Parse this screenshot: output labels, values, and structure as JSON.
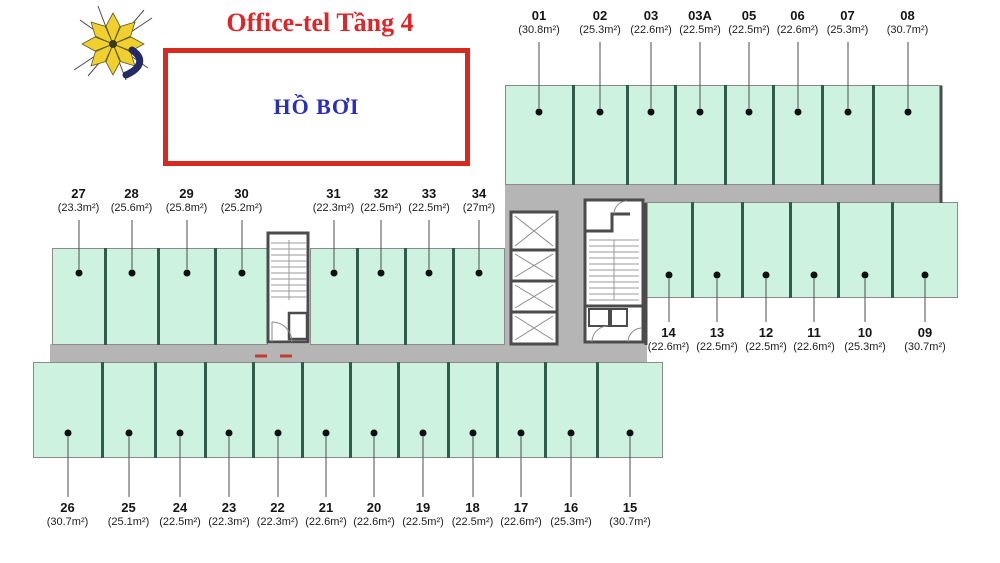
{
  "header": {
    "title": "Office-tel Tầng 4",
    "pool_label": "HỒ BƠI",
    "logo_icon": "pinwheel-flower-logo"
  },
  "colors": {
    "title_red": "#e02528",
    "box_border_red": "#d7291e",
    "pool_blue": "#2a2ebd",
    "unit_fill": "#cdf2e0",
    "unit_divider": "#2e5d4c",
    "corridor_gray": "#b5b5b5",
    "wall_dark": "#4b4b4b",
    "marker_black": "#101010",
    "door_mark_red": "#c23b2e"
  },
  "plan": {
    "rows": {
      "top": {
        "units": [
          {
            "no": "01",
            "area": "(30.8m²)"
          },
          {
            "no": "02",
            "area": "(25.3m²)"
          },
          {
            "no": "03",
            "area": "(22.6m²)"
          },
          {
            "no": "03A",
            "area": "(22.5m²)"
          },
          {
            "no": "05",
            "area": "(22.5m²)"
          },
          {
            "no": "06",
            "area": "(22.6m²)"
          },
          {
            "no": "07",
            "area": "(25.3m²)"
          },
          {
            "no": "08",
            "area": "(30.7m²)"
          }
        ]
      },
      "mid_left": {
        "units": [
          {
            "no": "27",
            "area": "(23.3m²)"
          },
          {
            "no": "28",
            "area": "(25.6m²)"
          },
          {
            "no": "29",
            "area": "(25.8m²)"
          },
          {
            "no": "30",
            "area": "(25.2m²)"
          },
          {
            "no": "31",
            "area": "(22.3m²)"
          },
          {
            "no": "32",
            "area": "(22.5m²)"
          },
          {
            "no": "33",
            "area": "(22.5m²)"
          },
          {
            "no": "34",
            "area": "(27m²)"
          }
        ]
      },
      "mid_right": {
        "units": [
          {
            "no": "14",
            "area": "(22.6m²)"
          },
          {
            "no": "13",
            "area": "(22.5m²)"
          },
          {
            "no": "12",
            "area": "(22.5m²)"
          },
          {
            "no": "11",
            "area": "(22.6m²)"
          },
          {
            "no": "10",
            "area": "(25.3m²)"
          },
          {
            "no": "09",
            "area": "(30.7m²)"
          }
        ]
      },
      "bottom": {
        "units": [
          {
            "no": "26",
            "area": "(30.7m²)"
          },
          {
            "no": "25",
            "area": "(25.1m²)"
          },
          {
            "no": "24",
            "area": "(22.5m²)"
          },
          {
            "no": "23",
            "area": "(22.3m²)"
          },
          {
            "no": "22",
            "area": "(22.3m²)"
          },
          {
            "no": "21",
            "area": "(22.6m²)"
          },
          {
            "no": "20",
            "area": "(22.6m²)"
          },
          {
            "no": "19",
            "area": "(22.5m²)"
          },
          {
            "no": "18",
            "area": "(22.5m²)"
          },
          {
            "no": "17",
            "area": "(22.6m²)"
          },
          {
            "no": "16",
            "area": "(25.3m²)"
          },
          {
            "no": "15",
            "area": "(30.7m²)"
          }
        ]
      }
    }
  }
}
